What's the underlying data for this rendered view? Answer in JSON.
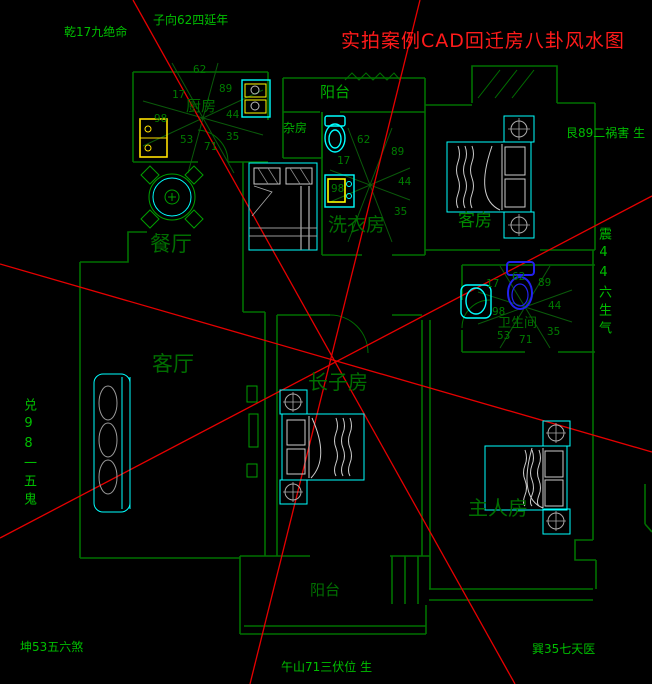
{
  "title": "实拍案例CAD回迁房八卦风水图",
  "bagua_labels": {
    "qian": "乾17九绝命",
    "zi": "子向62四延年",
    "gen": "艮89二祸害 生",
    "zhen": "震44六生气",
    "xun": "巽35七天医",
    "wu": "午山71三伏位 生",
    "kun": "坤53五六煞",
    "dui": "兑98一五鬼"
  },
  "rooms": {
    "kitchen": "厨房",
    "dining": "餐厅",
    "living": "客厅",
    "balcony_top": "阳台",
    "balcony_bottom": "阳台",
    "storage": "杂房",
    "laundry": "洗衣房",
    "guest": "客房",
    "bathroom": "卫生间",
    "eldest_son": "长子房",
    "master": "主人房"
  },
  "mini_bagua": {
    "kitchen_numbers": [
      "62",
      "17",
      "89",
      "98",
      "44",
      "53",
      "71",
      "35"
    ],
    "laundry_numbers": [
      "62",
      "17",
      "89",
      "98",
      "44",
      "35"
    ],
    "bathroom_numbers": [
      "17",
      "62",
      "89",
      "98",
      "44",
      "53",
      "71",
      "35"
    ]
  },
  "colors": {
    "title_red": "#ff1a1a",
    "red_line": "#e60000",
    "wall_green": "#007000",
    "furniture_cyan": "#00ffff",
    "label_bright_green": "#00be00",
    "label_dark_green": "#006e00",
    "appliance_yellow": "#ffff00",
    "toilet_blue": "#2222ee"
  }
}
